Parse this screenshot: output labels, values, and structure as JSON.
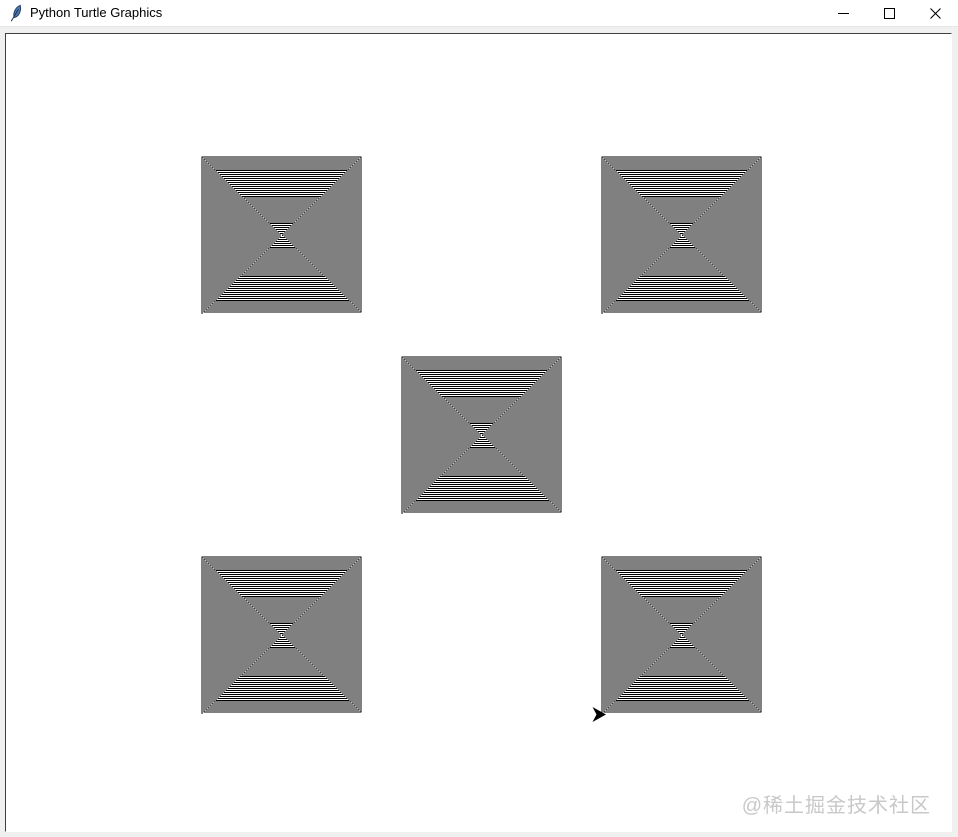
{
  "window": {
    "title": "Python Turtle Graphics",
    "titlebar_bg": "#ffffff",
    "title_color": "#000000",
    "icon_color": "#4f77aa",
    "icon_outline": "#17335c",
    "controls": [
      {
        "name": "minimize"
      },
      {
        "name": "maximize"
      },
      {
        "name": "close"
      }
    ]
  },
  "canvas": {
    "bg": "#ffffff",
    "window_bg": "#f0f0f0",
    "border_dark": "#404040",
    "border_light": "#ffffff"
  },
  "drawing": {
    "stroke_color": "#000000",
    "stroke_width": 1,
    "spiral": {
      "type": "square-spiral",
      "segments": 160,
      "step": 1,
      "turn": "left-90",
      "ring_spacing_px": 2
    },
    "spiral_rects": [
      {
        "name": "top-left",
        "x": 202,
        "y": 157,
        "w": 159,
        "h": 157
      },
      {
        "name": "top-right",
        "x": 602,
        "y": 157,
        "w": 159,
        "h": 157
      },
      {
        "name": "center",
        "x": 402,
        "y": 357,
        "w": 159,
        "h": 157
      },
      {
        "name": "bottom-left",
        "x": 202,
        "y": 557,
        "w": 159,
        "h": 157
      },
      {
        "name": "bottom-right",
        "x": 602,
        "y": 557,
        "w": 159,
        "h": 157
      }
    ],
    "turtle_cursor": {
      "x": 606,
      "y": 714.5,
      "heading": "east",
      "length": 13.5,
      "half_width": 7.5,
      "notch": 4,
      "color": "#000000"
    }
  },
  "watermark": {
    "text": "@稀土掘金技术社区",
    "color": "#c8c8c8"
  }
}
